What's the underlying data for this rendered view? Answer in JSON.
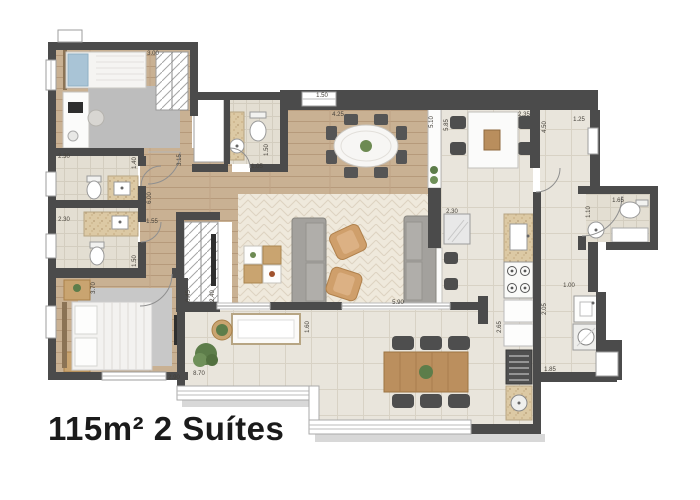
{
  "title_caption": "115m² 2 Suítes",
  "palette": {
    "wall": "#4b4b4b",
    "wood_floor": "#c9b193",
    "tile_floor": "#e9e5dc",
    "bath_tile": "#e3ded2",
    "living_rug": "#efe9dc",
    "gray_rug": "#bdbdbd",
    "counter_granite": "#dcc9a4",
    "sofa_gray": "#a3a19d",
    "armchair_tan": "#cf9f6b",
    "wood_furniture": "#bb8f5e",
    "chair_dark": "#4e4e4e",
    "plant_green": "#5d7d4a",
    "dimension_text": "#45413a",
    "caption_text": "#1b1b1b"
  },
  "dimensions": [
    {
      "label": "3.00",
      "x": 153,
      "y": 55,
      "rotate": 0
    },
    {
      "label": "2.30",
      "x": 64,
      "y": 158,
      "rotate": 0
    },
    {
      "label": "1.40",
      "x": 136,
      "y": 163,
      "rotate": -90
    },
    {
      "label": "2.30",
      "x": 64,
      "y": 221,
      "rotate": 0
    },
    {
      "label": "1.50",
      "x": 136,
      "y": 261,
      "rotate": -90
    },
    {
      "label": "3.15",
      "x": 181,
      "y": 160,
      "rotate": -90
    },
    {
      "label": "1.05",
      "x": 257,
      "y": 168,
      "rotate": 0
    },
    {
      "label": "1.50",
      "x": 268,
      "y": 150,
      "rotate": -90
    },
    {
      "label": "1.50",
      "x": 322,
      "y": 97,
      "rotate": 0
    },
    {
      "label": "4.25",
      "x": 338,
      "y": 116,
      "rotate": 0
    },
    {
      "label": "5.10",
      "x": 433,
      "y": 122,
      "rotate": -90
    },
    {
      "label": "5.85",
      "x": 448,
      "y": 125,
      "rotate": -90
    },
    {
      "label": "2.35",
      "x": 524,
      "y": 116,
      "rotate": 0
    },
    {
      "label": "4.50",
      "x": 546,
      "y": 127,
      "rotate": -90
    },
    {
      "label": "1.25",
      "x": 579,
      "y": 121,
      "rotate": 0
    },
    {
      "label": "1.65",
      "x": 618,
      "y": 202,
      "rotate": 0
    },
    {
      "label": "1.10",
      "x": 590,
      "y": 212,
      "rotate": -90
    },
    {
      "label": "6.00",
      "x": 151,
      "y": 198,
      "rotate": -90
    },
    {
      "label": "1.55",
      "x": 152,
      "y": 223,
      "rotate": 0
    },
    {
      "label": "0.45",
      "x": 190,
      "y": 296,
      "rotate": -90
    },
    {
      "label": "2.40",
      "x": 214,
      "y": 296,
      "rotate": -90
    },
    {
      "label": "2.30",
      "x": 452,
      "y": 213,
      "rotate": 0
    },
    {
      "label": "5.90",
      "x": 398,
      "y": 304,
      "rotate": 0
    },
    {
      "label": "1.60",
      "x": 309,
      "y": 327,
      "rotate": -90
    },
    {
      "label": "8.70",
      "x": 199,
      "y": 375,
      "rotate": 0
    },
    {
      "label": "3.70",
      "x": 95,
      "y": 288,
      "rotate": -90
    },
    {
      "label": "2.90",
      "x": 174,
      "y": 379,
      "rotate": 0
    },
    {
      "label": "2.65",
      "x": 501,
      "y": 327,
      "rotate": -90
    },
    {
      "label": "2.05",
      "x": 546,
      "y": 309,
      "rotate": -90
    },
    {
      "label": "1.00",
      "x": 569,
      "y": 287,
      "rotate": 0
    },
    {
      "label": "1.85",
      "x": 550,
      "y": 371,
      "rotate": 0
    }
  ]
}
